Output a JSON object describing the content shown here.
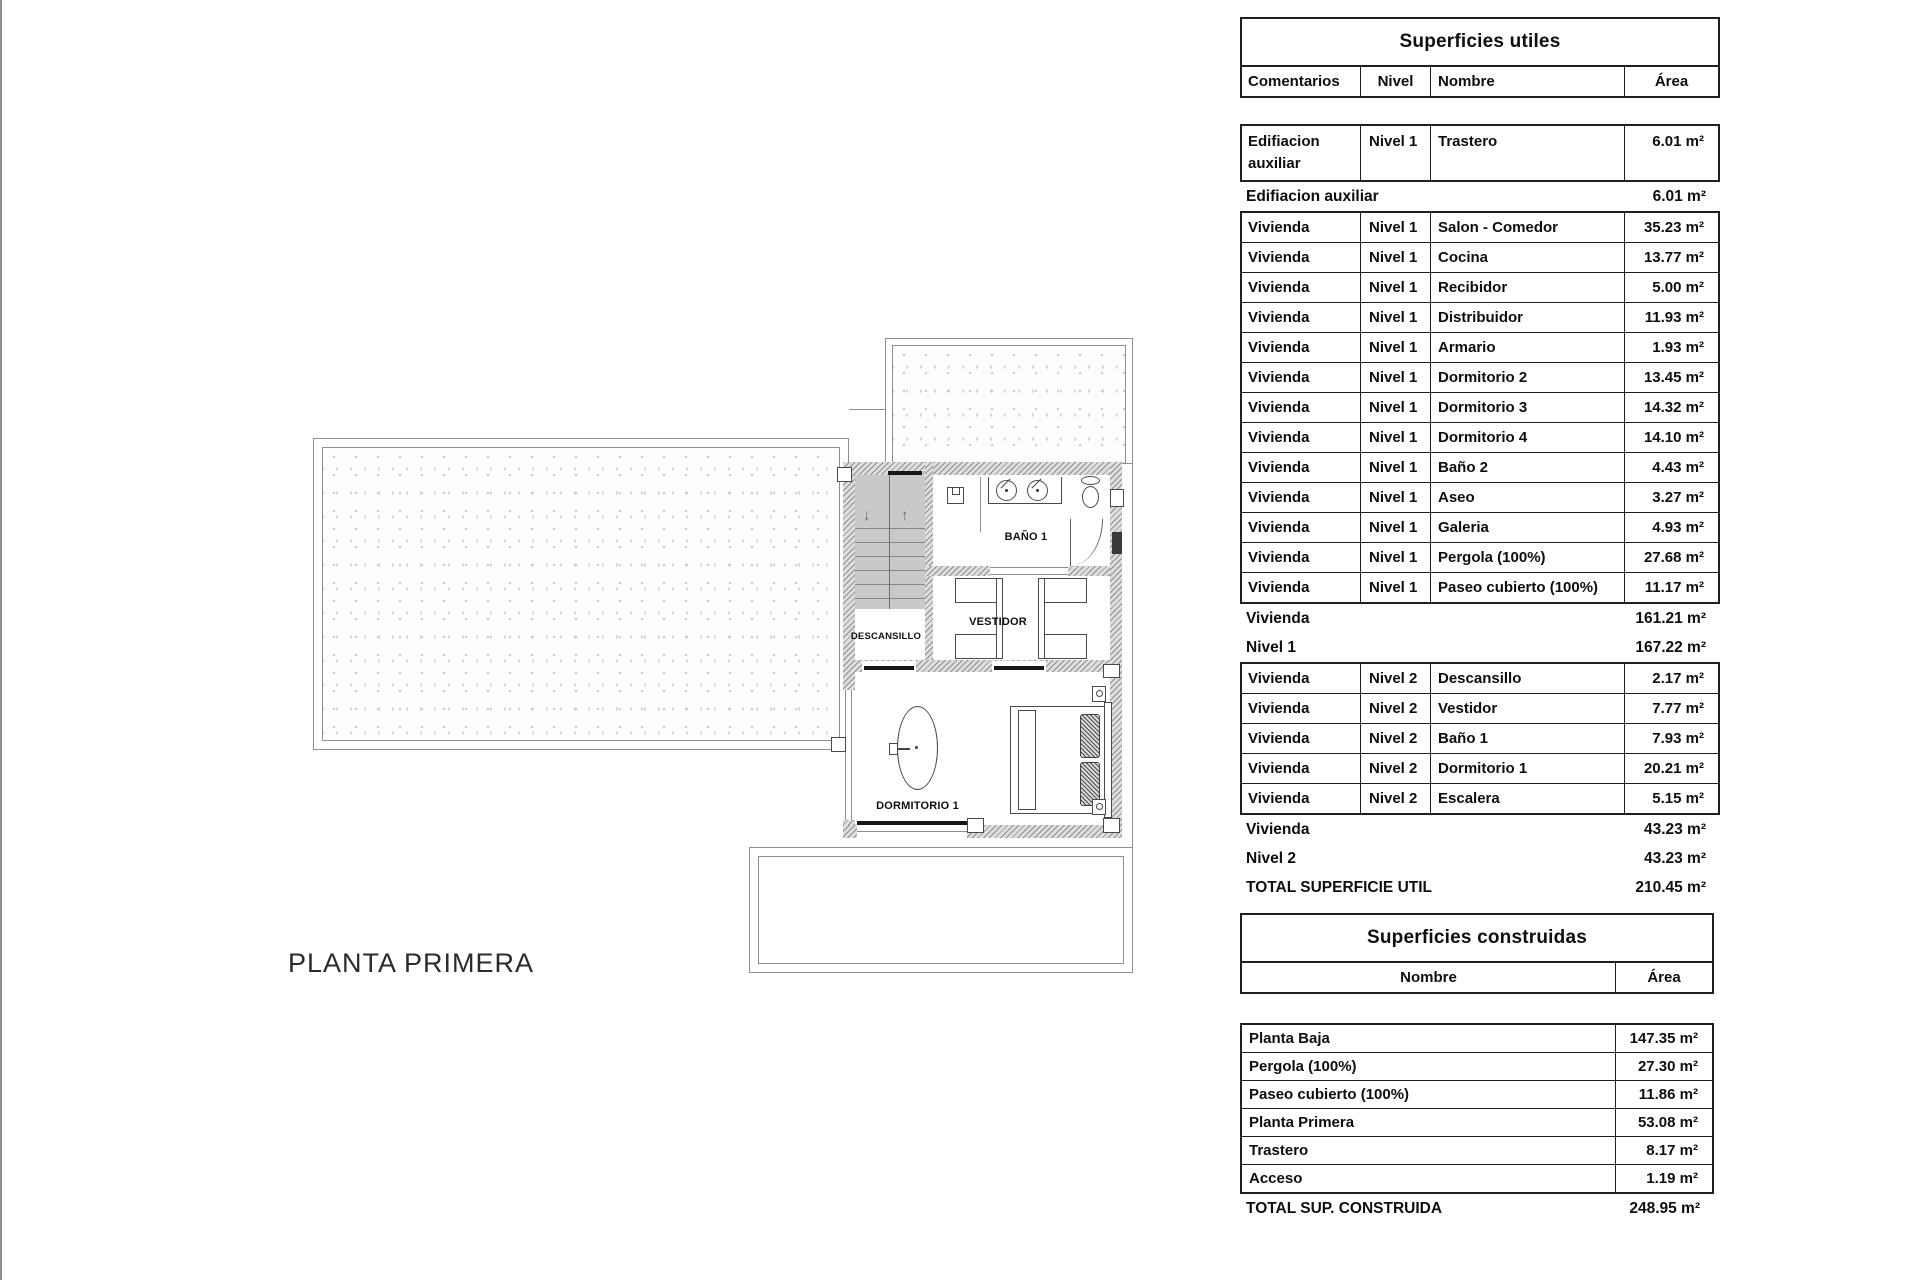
{
  "plan": {
    "title": "PLANTA PRIMERA",
    "labels": {
      "descansillo": "DESCANSILLO",
      "bano": "BAÑO 1",
      "vestidor": "VESTIDOR",
      "dormitorio": "DORMITORIO 1"
    },
    "stairs": {
      "down_arrow": "↓",
      "up_arrow": "↑"
    }
  },
  "su": {
    "title": "Superficies utiles",
    "headers": {
      "comentarios": "Comentarios",
      "nivel": "Nivel",
      "nombre": "Nombre",
      "area": "Área"
    },
    "rows_aux": [
      {
        "comentarios": "Edifiacion auxiliar",
        "nivel": "Nivel 1",
        "nombre": "Trastero",
        "area": "6.01 m²"
      }
    ],
    "subtotal_aux": {
      "label": "Edifiacion auxiliar",
      "area": "6.01 m²"
    },
    "rows_n1": [
      {
        "comentarios": "Vivienda",
        "nivel": "Nivel 1",
        "nombre": "Salon - Comedor",
        "area": "35.23 m²"
      },
      {
        "comentarios": "Vivienda",
        "nivel": "Nivel 1",
        "nombre": "Cocina",
        "area": "13.77 m²"
      },
      {
        "comentarios": "Vivienda",
        "nivel": "Nivel 1",
        "nombre": "Recibidor",
        "area": "5.00 m²"
      },
      {
        "comentarios": "Vivienda",
        "nivel": "Nivel 1",
        "nombre": "Distribuidor",
        "area": "11.93 m²"
      },
      {
        "comentarios": "Vivienda",
        "nivel": "Nivel 1",
        "nombre": "Armario",
        "area": "1.93 m²"
      },
      {
        "comentarios": "Vivienda",
        "nivel": "Nivel 1",
        "nombre": "Dormitorio 2",
        "area": "13.45 m²"
      },
      {
        "comentarios": "Vivienda",
        "nivel": "Nivel 1",
        "nombre": "Dormitorio 3",
        "area": "14.32 m²"
      },
      {
        "comentarios": "Vivienda",
        "nivel": "Nivel 1",
        "nombre": "Dormitorio 4",
        "area": "14.10 m²"
      },
      {
        "comentarios": "Vivienda",
        "nivel": "Nivel 1",
        "nombre": "Baño 2",
        "area": "4.43 m²"
      },
      {
        "comentarios": "Vivienda",
        "nivel": "Nivel 1",
        "nombre": "Aseo",
        "area": "3.27 m²"
      },
      {
        "comentarios": "Vivienda",
        "nivel": "Nivel 1",
        "nombre": "Galeria",
        "area": "4.93 m²"
      },
      {
        "comentarios": "Vivienda",
        "nivel": "Nivel 1",
        "nombre": "Pergola (100%)",
        "area": "27.68 m²"
      },
      {
        "comentarios": "Vivienda",
        "nivel": "Nivel 1",
        "nombre": "Paseo cubierto (100%)",
        "area": "11.17 m²"
      }
    ],
    "subtotal_vivienda1": {
      "label": "Vivienda",
      "area": "161.21 m²"
    },
    "subtotal_nivel1": {
      "label": "Nivel 1",
      "area": "167.22 m²"
    },
    "rows_n2": [
      {
        "comentarios": "Vivienda",
        "nivel": "Nivel 2",
        "nombre": "Descansillo",
        "area": "2.17 m²"
      },
      {
        "comentarios": "Vivienda",
        "nivel": "Nivel 2",
        "nombre": "Vestidor",
        "area": "7.77 m²"
      },
      {
        "comentarios": "Vivienda",
        "nivel": "Nivel 2",
        "nombre": "Baño 1",
        "area": "7.93 m²"
      },
      {
        "comentarios": "Vivienda",
        "nivel": "Nivel 2",
        "nombre": "Dormitorio 1",
        "area": "20.21 m²"
      },
      {
        "comentarios": "Vivienda",
        "nivel": "Nivel 2",
        "nombre": "Escalera",
        "area": "5.15 m²"
      }
    ],
    "subtotal_vivienda2": {
      "label": "Vivienda",
      "area": "43.23 m²"
    },
    "subtotal_nivel2": {
      "label": "Nivel 2",
      "area": "43.23 m²"
    },
    "total": {
      "label": "TOTAL SUPERFICIE UTIL",
      "area": "210.45 m²"
    }
  },
  "sc": {
    "title": "Superficies construidas",
    "headers": {
      "nombre": "Nombre",
      "area": "Área"
    },
    "rows": [
      {
        "nombre": "Planta Baja",
        "area": "147.35 m²"
      },
      {
        "nombre": "Pergola (100%)",
        "area": "27.30 m²"
      },
      {
        "nombre": "Paseo cubierto (100%)",
        "area": "11.86 m²"
      },
      {
        "nombre": "Planta Primera",
        "area": "53.08 m²"
      },
      {
        "nombre": "Trastero",
        "area": "8.17 m²"
      },
      {
        "nombre": "Acceso",
        "area": "1.19 m²"
      }
    ],
    "total": {
      "label": "TOTAL SUP. CONSTRUIDA",
      "area": "248.95 m²"
    }
  },
  "colors": {
    "line": "#8f8f8f",
    "wall_hatch": "#8f8f8f",
    "stair_fill": "#c9c9c9",
    "speckle": "#c6c6c6",
    "text": "#111111",
    "table_border": "#1f1f1f"
  }
}
